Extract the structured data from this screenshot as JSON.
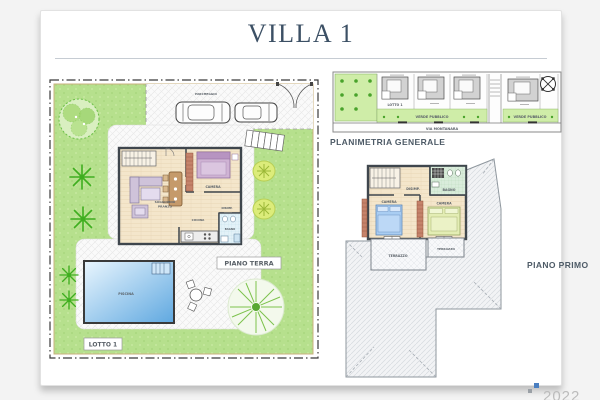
{
  "page": {
    "title": "VILLA 1",
    "year": "2022"
  },
  "colors": {
    "accent": "#3c5065",
    "garden_green": "#b6e08d",
    "public_green": "#cfeda8",
    "pool_blue": "#5fa8e0",
    "floor_beige": "#f4e6cb",
    "label_gray": "#4d5a66",
    "lot_red": "#cc3333"
  },
  "site_plan": {
    "piano_terra_label": "PIANO TERRA",
    "lotto_label": "LOTTO 1",
    "pool_label": "PISCINA",
    "parking_label": "PARCHEGGIO",
    "rooms": {
      "living_1": "SOGGIORNO",
      "living_2": "PRANZO",
      "kitchen": "CUCINA",
      "bedroom": "CAMERA",
      "bath": "BAGNO",
      "hall": "DISIMP."
    }
  },
  "general_plan": {
    "title": "PLANIMETRIA GENERALE",
    "green_area_label": "VERDE PUBBLICO",
    "road_label": "VIA MONTANARA",
    "lot_label": "LOTTO 1"
  },
  "first_floor": {
    "title": "PIANO PRIMO",
    "rooms": {
      "bedroom": "CAMERA",
      "bath": "BAGNO",
      "hall": "DISIMP.",
      "terrace": "TERRAZZO"
    }
  }
}
